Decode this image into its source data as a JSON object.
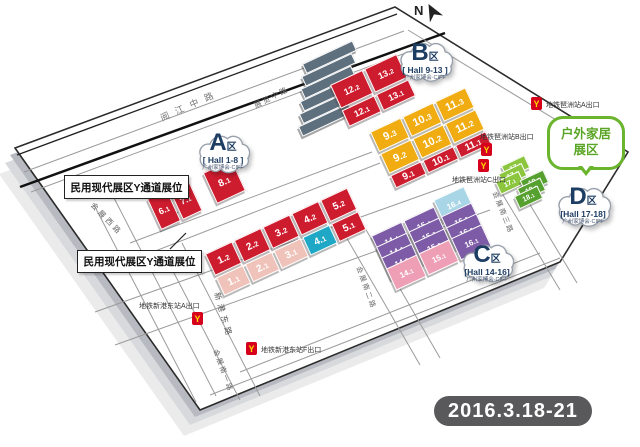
{
  "compass": {
    "label": "N"
  },
  "date_badge": {
    "text": "2016.3.18-21"
  },
  "notes": {
    "note1": "民用现代展区Y通道展位",
    "note2": "民用现代展区Y通道展位"
  },
  "bubble": {
    "line1": "户外家居",
    "line2": "展区"
  },
  "badges": {
    "a": {
      "letter": "A",
      "qu": "区",
      "hall": "[ Hall 1-8 ]",
      "sub": "广州家博会·CIFF"
    },
    "b": {
      "letter": "B",
      "qu": "区",
      "hall": "[ Hall 9-13 ]",
      "sub": "广州家博会·CIFF"
    },
    "c": {
      "letter": "C",
      "qu": "区",
      "hall": "[Hall 14-16]",
      "sub": "广州家博会·CIFF"
    },
    "d": {
      "letter": "D",
      "qu": "区",
      "hall": "[Hall 17-18]",
      "sub": "广州家博会·CIFF"
    }
  },
  "roads": {
    "yuejiang": "阅江中路",
    "zhanlan": "展览中路",
    "huizhanxi": "会展西路",
    "xingang": "新港东路",
    "nan1": "会展南一路",
    "nan2": "会展南二路",
    "nan3": "会展南三路"
  },
  "metro": {
    "pazhou_a": "地铁琶洲站A出口",
    "pazhou_b": "地铁琶洲站B出口",
    "pazhou_c": "地铁琶洲站C出口",
    "xingang_a": "地铁新港东站A出口",
    "xingang_f": "地铁新港东站F出口"
  },
  "zones": {
    "a_strip": {
      "halls": [
        {
          "label": "6.1"
        },
        {
          "label": "7.1"
        },
        {
          "label": "8.1"
        }
      ]
    },
    "a_main": {
      "halls": [
        {
          "label": "1.2"
        },
        {
          "label": "2.2"
        },
        {
          "label": "3.2"
        },
        {
          "label": "4.2"
        },
        {
          "label": "5.2"
        },
        {
          "label": "1.1"
        },
        {
          "label": "2.1"
        },
        {
          "label": "3.1"
        },
        {
          "label": "4.1"
        },
        {
          "label": "5.1"
        }
      ]
    },
    "b_upper": {
      "halls": [
        {
          "label": "12.2"
        },
        {
          "label": "13.2"
        },
        {
          "label": "12.1"
        },
        {
          "label": "13.1"
        }
      ]
    },
    "b_main": {
      "halls": [
        {
          "label": "9.3"
        },
        {
          "label": "10.3"
        },
        {
          "label": "11.3"
        },
        {
          "label": "9.2"
        },
        {
          "label": "10.2"
        },
        {
          "label": "11.2"
        },
        {
          "label": "9.1"
        },
        {
          "label": "10.1"
        },
        {
          "label": "11.1"
        }
      ]
    },
    "c": {
      "halls": [
        {
          "label": "14.4"
        },
        {
          "label": "15.4"
        },
        {
          "label": "16.4"
        },
        {
          "label": "14.3"
        },
        {
          "label": "15.3"
        },
        {
          "label": "16.3"
        },
        {
          "label": "14.2"
        },
        {
          "label": "15.2"
        },
        {
          "label": "16.2"
        },
        {
          "label": "14.1"
        },
        {
          "label": "15.1"
        },
        {
          "label": "16.1"
        }
      ]
    },
    "d": {
      "halls": [
        {
          "label": "17.3"
        },
        {
          "label": "17.2"
        },
        {
          "label": "17.1"
        },
        {
          "label": "18.3"
        },
        {
          "label": "18.2"
        },
        {
          "label": "18.1"
        }
      ]
    }
  },
  "colors": {
    "hall_red": "#ce1c2f",
    "hall_pink": "#f0c3ba",
    "hall_cyan": "#1fa7c6",
    "hall_yellow": "#f0ac10",
    "hall_purple": "#7d5ba6",
    "hall_rose": "#ee9fb6",
    "hall_lightblue": "#a9d6e6",
    "hall_green_light": "#8cc63f",
    "hall_green_dark": "#55a02e",
    "metro_red": "#d6001c",
    "metro_yellow": "#ffd800",
    "badge_navy": "#1d3d63",
    "bubble_green": "#6ab42e",
    "date_gray": "#59595c"
  }
}
